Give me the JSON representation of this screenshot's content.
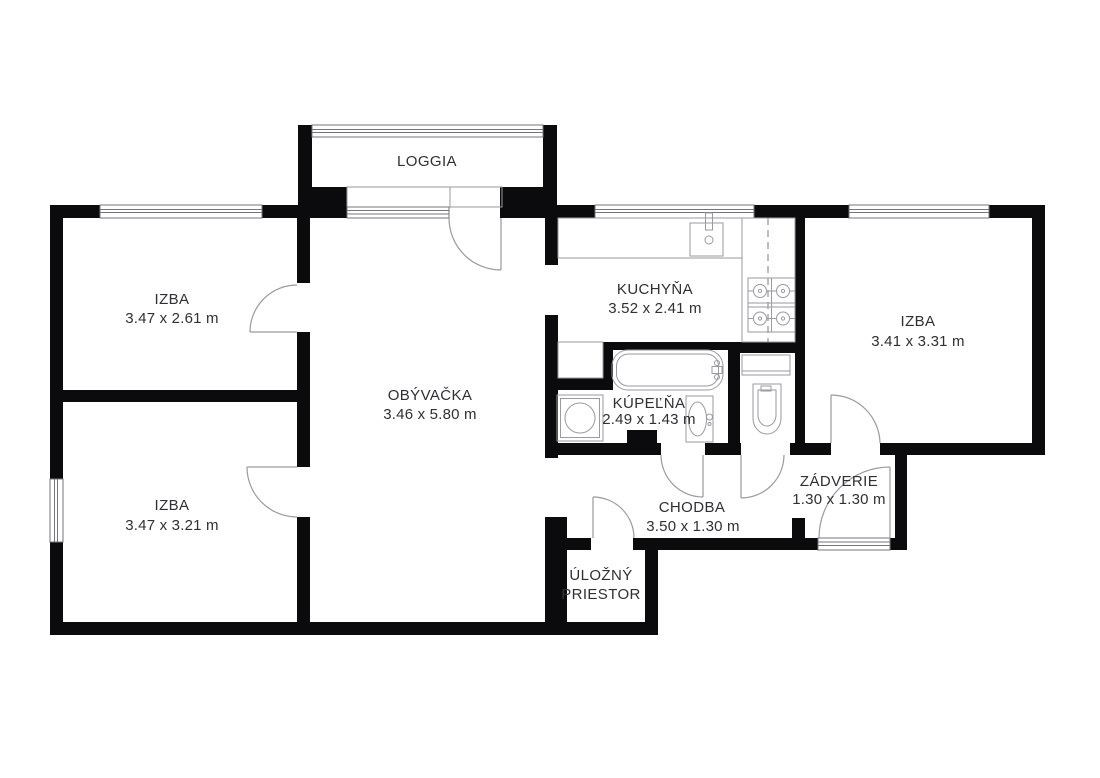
{
  "plan": {
    "title": "apartment-floor-plan",
    "rooms": {
      "loggia": {
        "name": "LOGGIA"
      },
      "izba_top_left": {
        "name": "IZBA",
        "dims": "3.47 x 2.61 m"
      },
      "kuchyna": {
        "name": "KUCHYŇA",
        "dims": "3.52 x 2.41 m"
      },
      "izba_right": {
        "name": "IZBA",
        "dims": "3.41 x 3.31 m"
      },
      "obyvacka": {
        "name": "OBÝVAČKA",
        "dims": "3.46 x 5.80 m"
      },
      "kupelna": {
        "name": "KÚPEĽŇA",
        "dims": "2.49 x 1.43 m"
      },
      "izba_bottom_left": {
        "name": "IZBA",
        "dims": "3.47 x 3.21 m"
      },
      "chodba": {
        "name": "CHODBA",
        "dims": "3.50 x 1.30 m"
      },
      "zadverie": {
        "name": "ZÁDVERIE",
        "dims": "1.30 x 1.30 m"
      },
      "ulozny_priestor": {
        "line1": "ÚLOŽNÝ",
        "line2": "PRIESTOR"
      }
    },
    "fixtures": [
      "kitchen-counter",
      "kitchen-sink",
      "stove",
      "bathtub",
      "washing-machine",
      "bathroom-sink",
      "toilet",
      "door-swing",
      "window"
    ],
    "colors": {
      "wall": "#0b0b0e",
      "thin_line": "#9a9aa0",
      "window_line": "#74747c",
      "text": "#2f2f35",
      "background": "#ffffff"
    }
  }
}
